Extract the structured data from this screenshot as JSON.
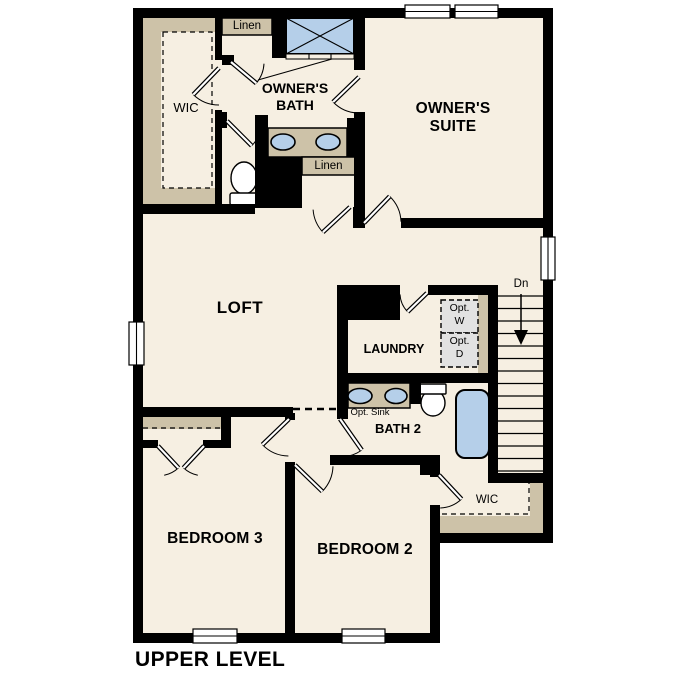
{
  "plan_title": "UPPER LEVEL",
  "rooms": {
    "owners_suite": "OWNER'S SUITE",
    "owners_bath": "OWNER'S BATH",
    "owners_wic": "WIC",
    "loft": "LOFT",
    "laundry": "LAUNDRY",
    "bath2": "BATH 2",
    "bedroom2": "BEDROOM 2",
    "bedroom3": "BEDROOM 3",
    "wic2": "WIC"
  },
  "closets": {
    "linen_top": "Linen",
    "linen_mid": "Linen"
  },
  "annotations": {
    "stair_direction": "Dn",
    "opt_sink": "Opt. Sink",
    "opt_washer_line1": "Opt.",
    "opt_washer_line2": "W",
    "opt_dryer_line1": "Opt.",
    "opt_dryer_line2": "D"
  },
  "colors": {
    "floor": "#f6efe2",
    "wall": "#000000",
    "fixture_blue": "#b5cfe9",
    "shelf_tan": "#cdc2a8",
    "appliance_gray": "#e2e2e2"
  }
}
